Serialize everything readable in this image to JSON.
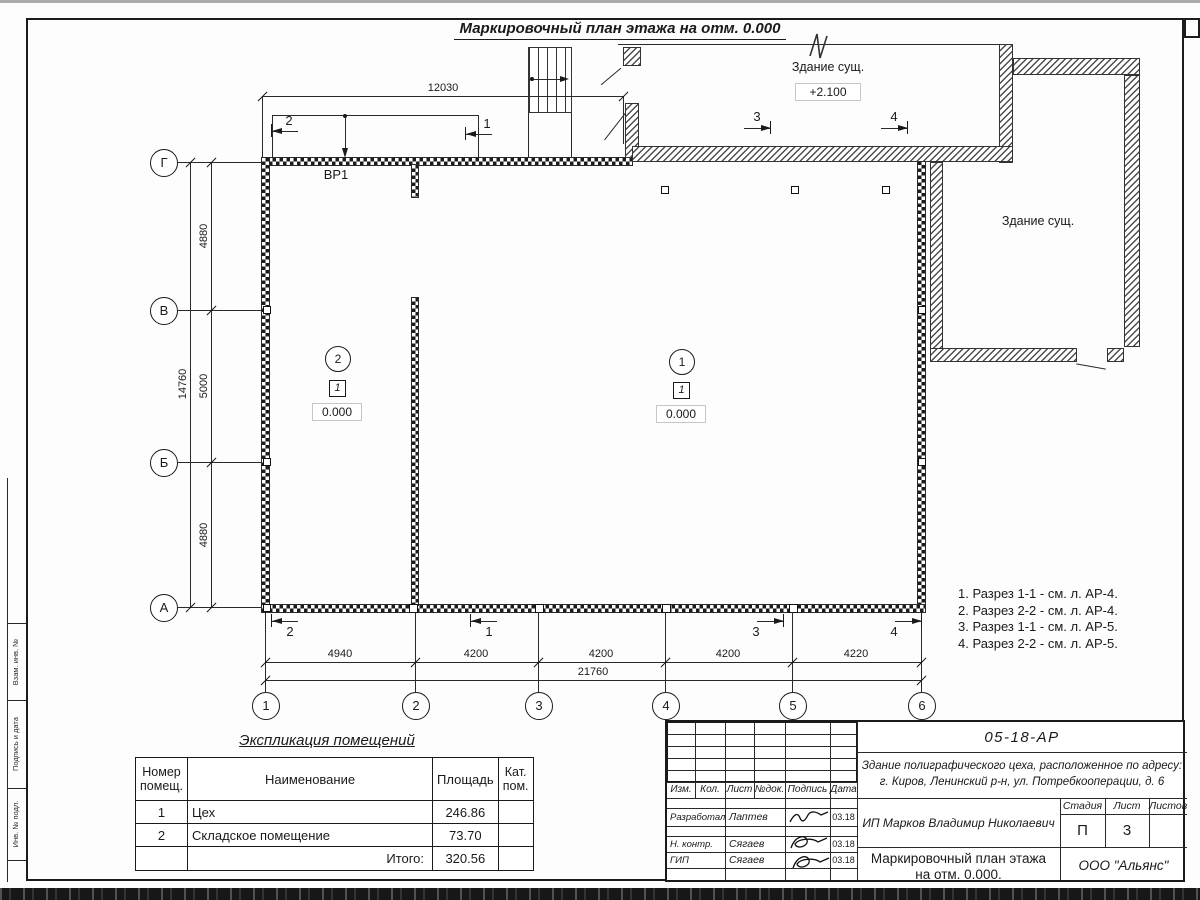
{
  "page": {
    "title": "Маркировочный план этажа на отм. 0.000"
  },
  "plan": {
    "dim_top": "12030",
    "dims_left": [
      "4880",
      "5000",
      "4880"
    ],
    "dim_left_total": "14760",
    "dims_bottom": [
      "4940",
      "4200",
      "4200",
      "4200",
      "4220"
    ],
    "dim_bottom_total": "21760",
    "axes_letters": [
      "Г",
      "В",
      "Б",
      "А"
    ],
    "axes_numbers": [
      "1",
      "2",
      "3",
      "4",
      "5",
      "6"
    ],
    "vr1_label": "ВР1",
    "existing_top": {
      "name": "Здание сущ.",
      "elevation": "+2.100"
    },
    "existing_right": {
      "name": "Здание сущ."
    },
    "marks": {
      "m1": "1",
      "m2": "2",
      "m3": "3",
      "m4": "4"
    },
    "rooms": [
      {
        "number": "2",
        "type_mark": "1",
        "elevation": "0.000"
      },
      {
        "number": "1",
        "type_mark": "1",
        "elevation": "0.000"
      }
    ]
  },
  "notes": [
    "1. Разрез 1-1 - см. л. АР-4.",
    "2. Разрез 2-2 - см. л. АР-4.",
    "3. Разрез 1-1 - см. л. АР-5.",
    "4. Разрез 2-2 - см. л. АР-5."
  ],
  "explication": {
    "title": "Экспликация помещений",
    "headers": [
      "Номер\nпомещ.",
      "Наименование",
      "Площадь",
      "Кат.\nпом."
    ],
    "rows": [
      {
        "num": "1",
        "name": "Цех",
        "area": "246.86",
        "cat": ""
      },
      {
        "num": "2",
        "name": "Складское помещение",
        "area": "73.70",
        "cat": ""
      }
    ],
    "total_label": "Итого:",
    "total_value": "320.56"
  },
  "titleblock": {
    "doc_code": "05-18-АР",
    "address": "Здание полиграфического цеха, расположенное по адресу:\nг. Киров,  Ленинский р-н, ул. Потребкооперации, д. 6",
    "cols": [
      "Изм.",
      "Кол.",
      "Лист",
      "№док.",
      "Подпись",
      "Дата"
    ],
    "sig_rows": [
      {
        "role": "Разработал",
        "name": "Лаптев",
        "date": "03.18"
      },
      {
        "role": "Н. контр.",
        "name": "Сягаев",
        "date": "03.18"
      },
      {
        "role": "ГИП",
        "name": "Сягаев",
        "date": "03.18"
      }
    ],
    "client": "ИП Марков Владимир Николаевич",
    "stage_cols": [
      "Стадия",
      "Лист",
      "Листов"
    ],
    "stage_value": "П",
    "sheet_value": "3",
    "sheets_total_value": "",
    "drawing_title": "Маркировочный план этажа\nна отм. 0.000.",
    "org": "ООО \"Альянс\""
  },
  "side_stamps": [
    "Взам. инв. №",
    "Подпись и дата",
    "Инв. № подл."
  ]
}
